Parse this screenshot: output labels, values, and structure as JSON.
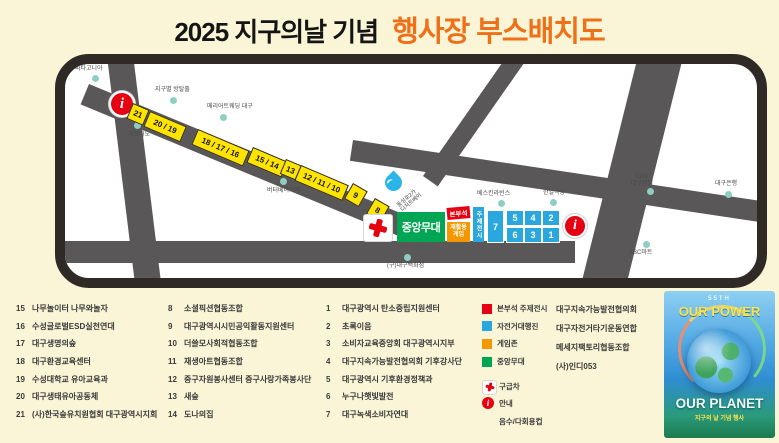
{
  "title": {
    "prefix": "2025 지구의날 기념",
    "main": "행사장 부스배치도"
  },
  "map": {
    "route_booths": [
      "21",
      "20 / 19",
      "18 / 17 / 16",
      "15 / 14",
      "13",
      "12 / 11 / 10",
      "9",
      "8"
    ],
    "info_icon": "i",
    "zones": {
      "stage": "중앙무대",
      "hq": "본부석",
      "game": {
        "line1": "재활용",
        "line2": "게임"
      },
      "theme": "주제전시"
    },
    "plaza_booths": {
      "single": "7",
      "top_row": [
        "5",
        "4",
        "2"
      ],
      "bottom_row": [
        "6",
        "3",
        "1"
      ]
    },
    "rotated_label": {
      "line1": "동성로2가",
      "line2": "디저트베이"
    },
    "landmarks": {
      "patagonia": "파타고니아",
      "escape_room": "지구별 방탈출",
      "giordano": "지오다노",
      "wedding": "메리어트웨딩 대구",
      "bakery": "버터베이커리",
      "baskin": "베스킨라빈스",
      "hanil": "한일극장",
      "cgv_line1": "CGV",
      "cgv_line2": "대구한일",
      "bank": "대구은행",
      "abc_mart": "ABC마트",
      "old_dept_store": "(구)대구백화점"
    }
  },
  "directory": {
    "col1": [
      {
        "num": "15",
        "name": "나무놀이터 나무와놀자"
      },
      {
        "num": "16",
        "name": "수성글로벌ESD실천연대"
      },
      {
        "num": "17",
        "name": "대구생명의숲"
      },
      {
        "num": "18",
        "name": "대구환경교육센터"
      },
      {
        "num": "19",
        "name": "수성대학교 유아교육과"
      },
      {
        "num": "20",
        "name": "대구생태유아공동체"
      },
      {
        "num": "21",
        "name": "(사)한국숲유치원협회 대구광역시지회"
      }
    ],
    "col2": [
      {
        "num": "8",
        "name": "소셜픽션협동조합"
      },
      {
        "num": "9",
        "name": "대구광역시시민공익활동지원센터"
      },
      {
        "num": "10",
        "name": "더쓸모사회적협동조합"
      },
      {
        "num": "11",
        "name": "재생아트협동조합"
      },
      {
        "num": "12",
        "name": "중구자원봉사센터 중구사랑가족봉사단"
      },
      {
        "num": "13",
        "name": "새숲"
      },
      {
        "num": "14",
        "name": "도나의집"
      }
    ],
    "col3": [
      {
        "num": "1",
        "name": "대구광역시 탄소중립지원센터"
      },
      {
        "num": "2",
        "name": "초록이음"
      },
      {
        "num": "3",
        "name": "소비자교육중앙회 대구광역시지부"
      },
      {
        "num": "4",
        "name": "대구지속가능발전협의회 기후강사단"
      },
      {
        "num": "5",
        "name": "대구광역시 기후환경정책과"
      },
      {
        "num": "6",
        "name": "누구나햇빛발전"
      },
      {
        "num": "7",
        "name": "대구녹색소비자연대"
      }
    ]
  },
  "legend": {
    "zones": [
      {
        "color": "#e50012",
        "label": "본부석 주제전시"
      },
      {
        "color": "#2ba7df",
        "label": "자전거대행진"
      },
      {
        "color": "#f39800",
        "label": "게임존"
      },
      {
        "color": "#00a651",
        "label": "중앙무대"
      }
    ],
    "icons": [
      {
        "type": "ambulance-cross",
        "label": "구급차"
      },
      {
        "type": "info",
        "label": "안내"
      },
      {
        "type": "water-drop",
        "label": "음수/다회용컵"
      }
    ],
    "partners": [
      "대구지속가능발전협의회",
      "대구자전거타기운동연합",
      "메세지팩토리협동조합",
      "(사)인디053"
    ]
  },
  "poster": {
    "top_small": "55TH",
    "title_top": "OUR POWER",
    "title_bottom": "OUR PLANET",
    "caption": "지구의 날 기념 행사"
  },
  "colors": {
    "background": "#faf5d6",
    "title_accent": "#ee7018",
    "road": "#595757",
    "frame": "#2f2a26",
    "booth_yellow": "#ffe400",
    "booth_blue": "#2ba7df",
    "stage_green": "#00a651",
    "hq_red": "#e50012",
    "game_orange": "#f39800",
    "landmark_dot": "#8fcec3"
  }
}
